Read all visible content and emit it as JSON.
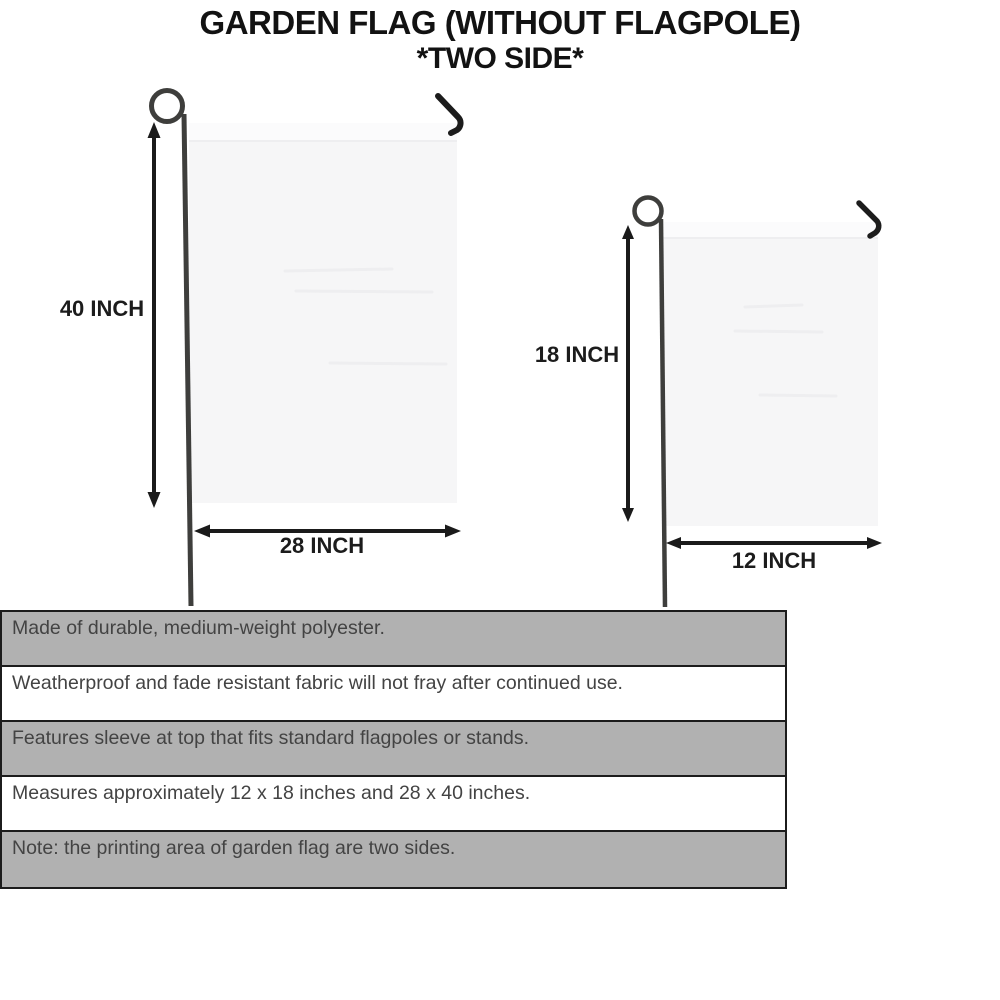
{
  "title": {
    "line1": "GARDEN FLAG (WITHOUT FLAGPOLE)",
    "line2": "*TWO SIDE*"
  },
  "diagrams": {
    "large_flag": {
      "name": "28 x 40 inch garden flag",
      "height_label": "40 INCH",
      "width_label": "28 INCH"
    },
    "small_flag": {
      "name": "12 x 18 inch garden flag",
      "height_label": "18 INCH",
      "width_label": "12 INCH"
    }
  },
  "specs": {
    "rows": [
      {
        "text": "Made of durable, medium-weight polyester."
      },
      {
        "text": "Weatherproof and fade resistant fabric will not fray after continued use."
      },
      {
        "text": "Features sleeve at top that fits standard flagpoles or stands."
      },
      {
        "text": "Measures approximately 12 x 18 inches and 28 x 40 inches."
      },
      {
        "text": "Note: the printing area of garden flag are two sides."
      }
    ]
  },
  "colors": {
    "row_gray": "#b1b1b1",
    "row_white": "#ffffff",
    "table_border": "#1c1c1c",
    "flag_fill": "#f6f6f7",
    "flag_sleeve": "#fbfbfc",
    "pole": "#3e3e3c",
    "arrow": "#1a1a1a",
    "text_dark": "#434343"
  }
}
